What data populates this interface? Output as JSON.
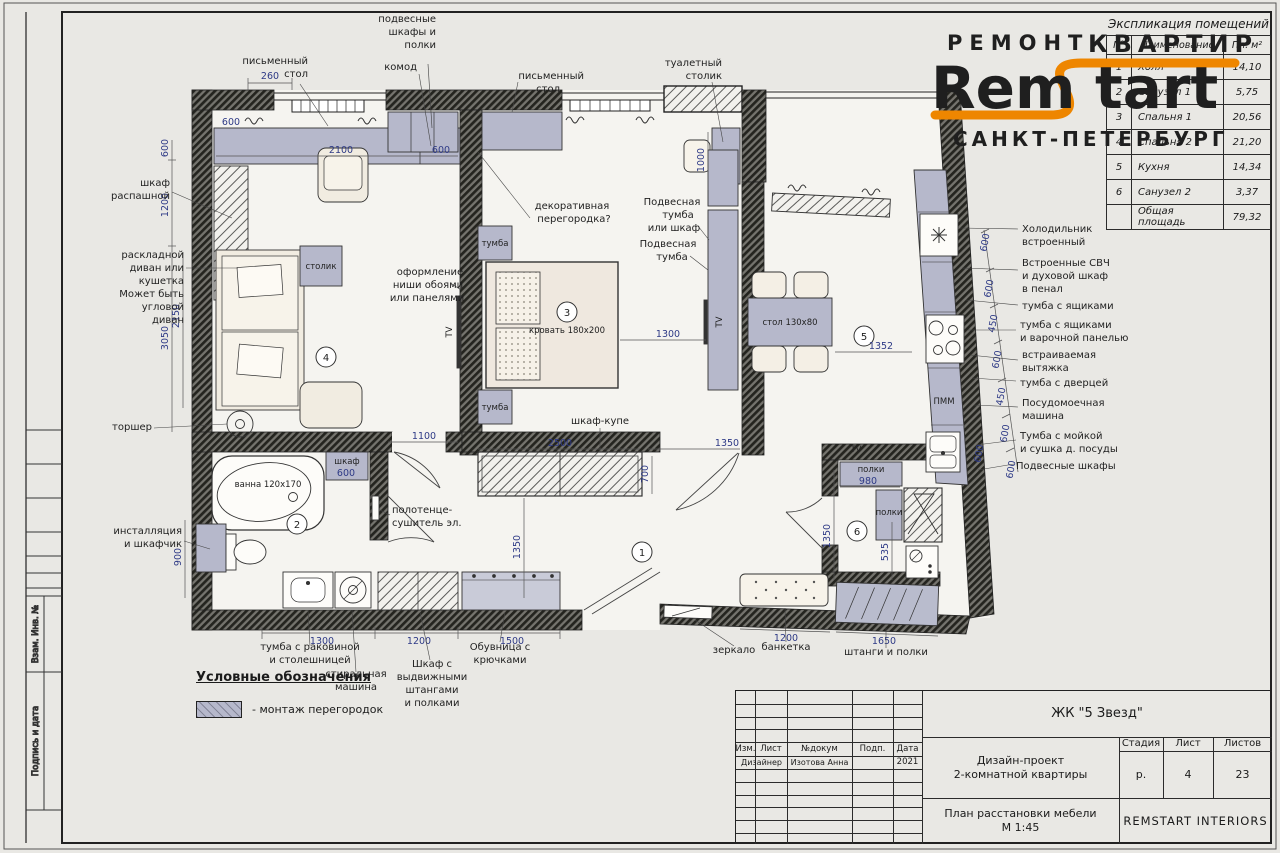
{
  "logo": {
    "top": "РЕМОНТ",
    "kvartir": "КВАРТИР",
    "brand_left": "Rem",
    "brand_right": "tart",
    "city": "САНКТ-ПЕТЕРБУРГ",
    "accent": "#ee8600"
  },
  "schedule": {
    "title": "Экспликация помещений",
    "col_n": "N°",
    "col_name": "Наименование",
    "col_area": "Пл. м²",
    "rows": [
      {
        "n": "1",
        "name": "Холл",
        "area": "14,10"
      },
      {
        "n": "2",
        "name": "Санузел 1",
        "area": "5,75"
      },
      {
        "n": "3",
        "name": "Спальня 1",
        "area": "20,56"
      },
      {
        "n": "4",
        "name": "Спальня 2",
        "area": "21,20"
      },
      {
        "n": "5",
        "name": "Кухня",
        "area": "14,34"
      },
      {
        "n": "6",
        "name": "Санузел 2",
        "area": "3,37"
      },
      {
        "n": "",
        "name": "Общая площадь",
        "area": "79,32"
      }
    ]
  },
  "legend": {
    "title": "Условные обозначения",
    "item": "- монтаж перегородок"
  },
  "margin_stamp": {
    "cell1": "Взам. Инв. №",
    "cell2": "Подпись и дата"
  },
  "titleblock": {
    "project": "ЖК \"5 Звезд\"",
    "h_izm": "Изм.",
    "h_list": "Лист",
    "h_doc": "№докум",
    "h_sign": "Подп.",
    "h_date": "Дата",
    "designer": "Дизайнер",
    "designer_name": "Изотова Анна",
    "year": "2021",
    "subject1": "Дизайн-проект",
    "subject2": "2-комнатной квартиры",
    "h_stage": "Стадия",
    "h_sheet": "Лист",
    "h_sheets": "Листов",
    "stage": "р.",
    "sheet": "4",
    "sheets": "23",
    "drawing": "План расстановки мебели",
    "scale": "М 1:45",
    "company": "REMSTART INTERIORS"
  },
  "plan": {
    "rooms": {
      "hall": "1",
      "bath1": "2",
      "bedroom": "3",
      "living": "4",
      "kitchen": "5",
      "bath2": "6"
    },
    "furniture": {
      "side_table": "столик",
      "bed": "кровать 180х200",
      "nightstand1": "тумба",
      "nightstand2": "тумба",
      "wardrobe": "шкаф-купе",
      "dining_table": "стол 130х80",
      "bath": "ванна 120х170",
      "bath_cabinet": "шкаф",
      "shelves1": "полки",
      "shelves2": "полки",
      "dishwasher": "ПММ",
      "tv1": "TV",
      "tv2": "TV",
      "tv3": "TV"
    },
    "annotations": {
      "desk_left": [
        "письменный",
        "стол"
      ],
      "hanging": [
        "подвесные",
        "шкафы и",
        "полки"
      ],
      "dresser": "комод",
      "desk_right": [
        "письменный",
        "стол"
      ],
      "vanity": [
        "туалетный",
        "столик"
      ],
      "swing_wardrobe": [
        "шкаф",
        "распашной"
      ],
      "sofa": [
        "раскладной",
        "диван или",
        "кушетка",
        "Может быть",
        "угловой",
        "диван"
      ],
      "floor_lamp": "торшер",
      "installation": [
        "инсталляция",
        "и шкафчик"
      ],
      "fridge": [
        "Холодильник",
        "встроенный"
      ],
      "oven": [
        "Встроенные СВЧ",
        "и духовой шкаф",
        "в пенал"
      ],
      "drawers": "тумба с ящиками",
      "hob": [
        "тумба с ящиками",
        "и варочной панелью"
      ],
      "hood": [
        "встраиваемая",
        "вытяжка"
      ],
      "door_cab": "тумба с дверцей",
      "dw": [
        "Посудомоечная",
        "машина"
      ],
      "sink_cab": [
        "Тумба с мойкой",
        "и сушка д. посуды"
      ],
      "wall_cabs": "Подвесные шкафы",
      "vanity_sink": [
        "тумба с раковиной",
        "и столешницей"
      ],
      "washer": [
        "стиральная",
        "машина"
      ],
      "hall_wardrobe": [
        "Шкаф с",
        "выдвижными",
        "штангами",
        "и полками"
      ],
      "shoe_rack": [
        "Обувница с",
        "крючками"
      ],
      "mirror": "зеркало",
      "bench": "банкетка",
      "rails": "штанги и полки",
      "partition": [
        "декоративная",
        "перегородка?"
      ],
      "niche": [
        "оформление",
        "ниши обоями",
        "или панелями"
      ],
      "hang_cab1": [
        "Подвесная",
        "тумба",
        "или шкаф"
      ],
      "hang_cab2": [
        "Подвесная",
        "тумба"
      ],
      "towel": [
        "полотенце-",
        "сушитель эл."
      ]
    },
    "dims": [
      "260",
      "600",
      "2100",
      "600",
      "600",
      "1200",
      "2150",
      "3050",
      "900",
      "1000",
      "1300",
      "1100",
      "2500",
      "1350",
      "700",
      "1350",
      "1352",
      "980",
      "1350",
      "535",
      "1300",
      "1200",
      "1500",
      "1200",
      "1650",
      "600",
      "600",
      "600",
      "450",
      "600",
      "450",
      "600",
      "600",
      "600"
    ]
  }
}
